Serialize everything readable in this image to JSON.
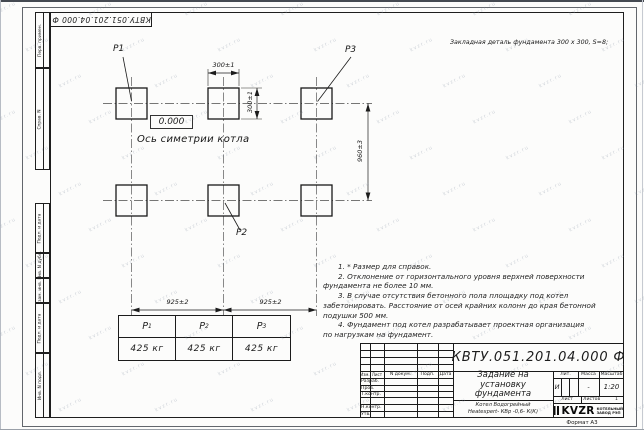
{
  "corner_stamp": {
    "doc_number": "КВТУ.051.201.04.000  Ф"
  },
  "plate_note": "Закладная деталь фундамента  300 x 300,  S=8;",
  "drawing": {
    "p1": "P1",
    "p2": "P2",
    "p3": "P3",
    "level_mark": "0.000",
    "axis_caption": "Ось симетрии котла",
    "dim_top_width": "300±1",
    "dim_side_height": "300±1",
    "dim_row_spacing": "960±3",
    "dim_col_left": "925±2",
    "dim_col_right": "925±2"
  },
  "notes_lines": [
    {
      "t": "1. * Размер для справок."
    },
    {
      "t": "2. Отклонение от горизонтального уровня верхней поверхности"
    },
    {
      "t": "фундамента не более 10 мм."
    },
    {
      "t": "3. В случае отсутствия бетонного пола площадку под котел"
    },
    {
      "t": "забетонировать. Расстояние от осей крайних колонн до края бетонной"
    },
    {
      "t": "подушки 500 мм."
    },
    {
      "t": "4. Фундамент под котел разрабатывает проектная организация"
    },
    {
      "t": "по нагрузкам на фундамент."
    }
  ],
  "load_table": {
    "headers": [
      [
        "P",
        "1"
      ],
      [
        "P",
        "2"
      ],
      [
        "P",
        "3"
      ]
    ],
    "values": [
      "425 кг",
      "425 кг",
      "425 кг"
    ]
  },
  "side_stamp": {
    "top": [
      "Перв. примен.",
      "Справ. N"
    ],
    "bottom": [
      "Подп. и дата",
      "Инв. N дубл.",
      "Взам. инв. N",
      "Подп. и дата",
      "Инв. N подл."
    ]
  },
  "title_block": {
    "doc_number": "КВТУ.051.201.04.000  Ф",
    "title_lines": [
      "Задание на",
      "установку",
      "фундамента"
    ],
    "product_lines": [
      "Котел Водогрейный",
      "Heatexpert- КВр -0,6- К(К)"
    ],
    "header_row": [
      "Изм.",
      "Лист",
      "N докум.",
      "Подп.",
      "Дата"
    ],
    "row_labels": [
      "Разраб.",
      "Пров.",
      "Т.контр.",
      "Н.контр.",
      "Утв."
    ],
    "lit_label": "Лит.",
    "mass_label": "Масса",
    "scale_label": "Масштаб",
    "lit_value": "И",
    "mass_value": "-",
    "scale_value": "1:20",
    "sheet_label": "Лист",
    "sheets_label": "Листов",
    "sheets_value": "1",
    "logo_text": "KVZR",
    "company_lines": [
      "КОТЕЛЬНЫЙ",
      "ЗАВОД РЭП"
    ],
    "format_label": "Формат А3"
  },
  "watermark": {
    "text": "kvzr.ru"
  },
  "colors": {
    "line": "#1e1e1e",
    "watermark": "#808ca0"
  }
}
